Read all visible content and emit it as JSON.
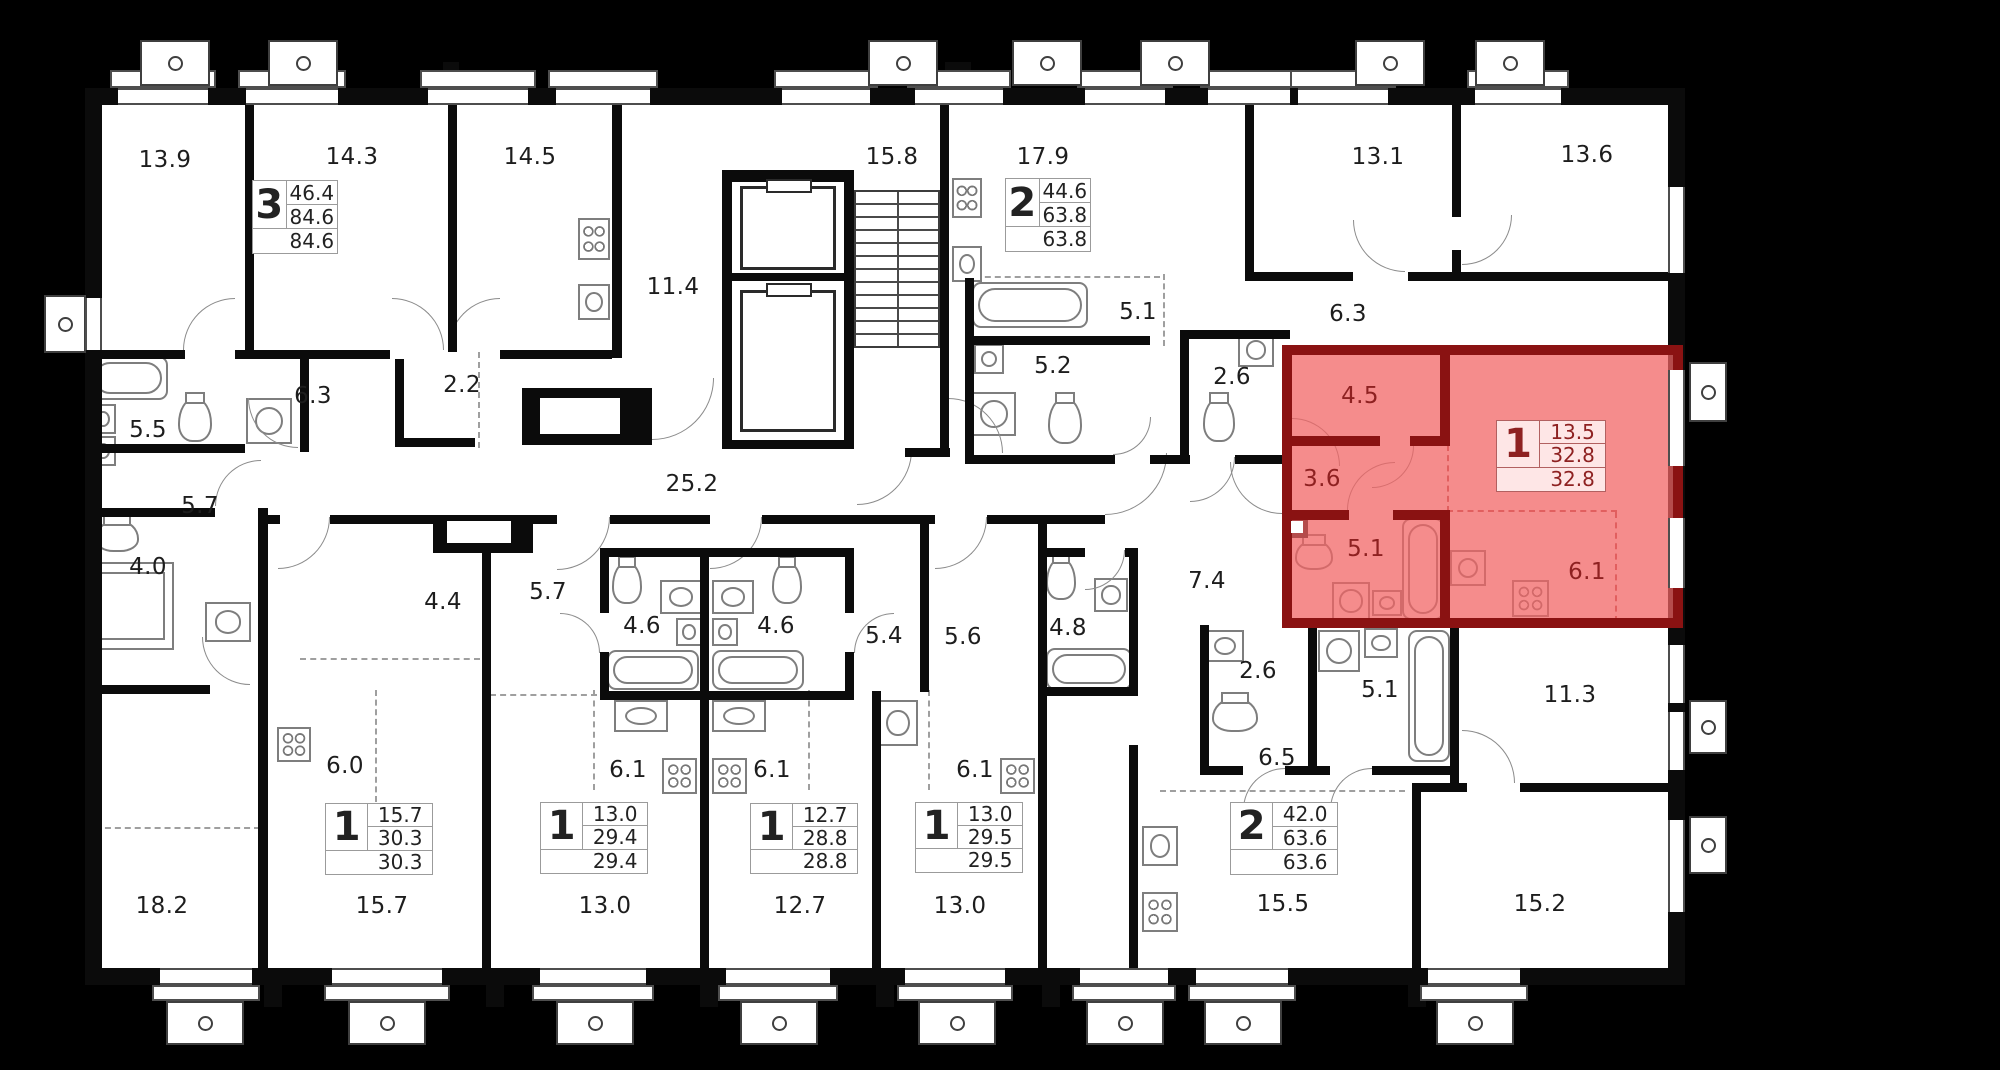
{
  "plan_name": "apartment-floor-plan",
  "colors": {
    "background": "#000000",
    "walls": "#0b0b0b",
    "floor": "#ffffff",
    "highlight_fill": "#f26464",
    "highlight_wall": "#8a1212",
    "highlight_text": "#8e2121",
    "label_text": "#1d1d1d"
  },
  "room_labels": [
    {
      "t": "13.9",
      "x": 165,
      "y": 160,
      "red": false
    },
    {
      "t": "14.3",
      "x": 352,
      "y": 157,
      "red": false
    },
    {
      "t": "14.5",
      "x": 530,
      "y": 157,
      "red": false
    },
    {
      "t": "11.4",
      "x": 673,
      "y": 287,
      "red": false
    },
    {
      "t": "15.8",
      "x": 892,
      "y": 157,
      "red": false
    },
    {
      "t": "17.9",
      "x": 1043,
      "y": 157,
      "red": false
    },
    {
      "t": "13.1",
      "x": 1378,
      "y": 157,
      "red": false
    },
    {
      "t": "13.6",
      "x": 1587,
      "y": 155,
      "red": false
    },
    {
      "t": "6.3",
      "x": 313,
      "y": 396,
      "red": false
    },
    {
      "t": "2.2",
      "x": 462,
      "y": 385,
      "red": false
    },
    {
      "t": "5.5",
      "x": 148,
      "y": 430,
      "red": false
    },
    {
      "t": "5.7",
      "x": 200,
      "y": 506,
      "red": false
    },
    {
      "t": "4.0",
      "x": 148,
      "y": 567,
      "red": false
    },
    {
      "t": "25.2",
      "x": 692,
      "y": 484,
      "red": false
    },
    {
      "t": "5.1",
      "x": 1138,
      "y": 312,
      "red": false
    },
    {
      "t": "5.2",
      "x": 1053,
      "y": 366,
      "red": false
    },
    {
      "t": "2.6",
      "x": 1232,
      "y": 377,
      "red": false
    },
    {
      "t": "6.3",
      "x": 1348,
      "y": 314,
      "red": false
    },
    {
      "t": "4.4",
      "x": 443,
      "y": 602,
      "red": false
    },
    {
      "t": "5.7",
      "x": 548,
      "y": 592,
      "red": false
    },
    {
      "t": "4.6",
      "x": 642,
      "y": 626,
      "red": false
    },
    {
      "t": "4.6",
      "x": 776,
      "y": 626,
      "red": false
    },
    {
      "t": "5.4",
      "x": 884,
      "y": 636,
      "red": false
    },
    {
      "t": "5.6",
      "x": 963,
      "y": 637,
      "red": false
    },
    {
      "t": "4.8",
      "x": 1068,
      "y": 628,
      "red": false
    },
    {
      "t": "7.4",
      "x": 1207,
      "y": 581,
      "red": false
    },
    {
      "t": "2.6",
      "x": 1258,
      "y": 671,
      "red": false
    },
    {
      "t": "5.1",
      "x": 1380,
      "y": 690,
      "red": false
    },
    {
      "t": "11.3",
      "x": 1570,
      "y": 695,
      "red": false
    },
    {
      "t": "6.5",
      "x": 1277,
      "y": 758,
      "red": false
    },
    {
      "t": "6.0",
      "x": 345,
      "y": 766,
      "red": false
    },
    {
      "t": "6.1",
      "x": 628,
      "y": 770,
      "red": false
    },
    {
      "t": "6.1",
      "x": 772,
      "y": 770,
      "red": false
    },
    {
      "t": "6.1",
      "x": 975,
      "y": 770,
      "red": false
    },
    {
      "t": "18.2",
      "x": 162,
      "y": 906,
      "red": false
    },
    {
      "t": "15.7",
      "x": 382,
      "y": 906,
      "red": false
    },
    {
      "t": "13.0",
      "x": 605,
      "y": 906,
      "red": false
    },
    {
      "t": "12.7",
      "x": 800,
      "y": 906,
      "red": false
    },
    {
      "t": "13.0",
      "x": 960,
      "y": 906,
      "red": false
    },
    {
      "t": "15.5",
      "x": 1283,
      "y": 904,
      "red": false
    },
    {
      "t": "15.2",
      "x": 1540,
      "y": 904,
      "red": false
    },
    {
      "t": "4.5",
      "x": 1360,
      "y": 396,
      "red": true
    },
    {
      "t": "3.6",
      "x": 1322,
      "y": 479,
      "red": true
    },
    {
      "t": "5.1",
      "x": 1366,
      "y": 549,
      "red": true
    },
    {
      "t": "6.1",
      "x": 1587,
      "y": 572,
      "red": true
    }
  ],
  "unit_tables": [
    {
      "n": "3",
      "rows": [
        "46.4",
        "84.6",
        "84.6"
      ],
      "x": 252,
      "y": 180,
      "w": 86,
      "h": 74,
      "red": false
    },
    {
      "n": "2",
      "rows": [
        "44.6",
        "63.8",
        "63.8"
      ],
      "x": 1005,
      "y": 178,
      "w": 86,
      "h": 74,
      "red": false
    },
    {
      "n": "1",
      "rows": [
        "13.5",
        "32.8",
        "32.8"
      ],
      "x": 1496,
      "y": 420,
      "w": 110,
      "h": 72,
      "red": true
    },
    {
      "n": "1",
      "rows": [
        "15.7",
        "30.3",
        "30.3"
      ],
      "x": 325,
      "y": 803,
      "w": 108,
      "h": 72,
      "red": false
    },
    {
      "n": "1",
      "rows": [
        "13.0",
        "29.4",
        "29.4"
      ],
      "x": 540,
      "y": 802,
      "w": 108,
      "h": 72,
      "red": false
    },
    {
      "n": "1",
      "rows": [
        "12.7",
        "28.8",
        "28.8"
      ],
      "x": 750,
      "y": 803,
      "w": 108,
      "h": 71,
      "red": false
    },
    {
      "n": "1",
      "rows": [
        "13.0",
        "29.5",
        "29.5"
      ],
      "x": 915,
      "y": 802,
      "w": 108,
      "h": 71,
      "red": false
    },
    {
      "n": "2",
      "rows": [
        "42.0",
        "63.6",
        "63.6"
      ],
      "x": 1230,
      "y": 802,
      "w": 108,
      "h": 73,
      "red": false
    }
  ],
  "selected_apartment": {
    "rooms": "1",
    "area_living": "13.5",
    "area_total": "32.8",
    "area_total_reduced": "32.8"
  }
}
